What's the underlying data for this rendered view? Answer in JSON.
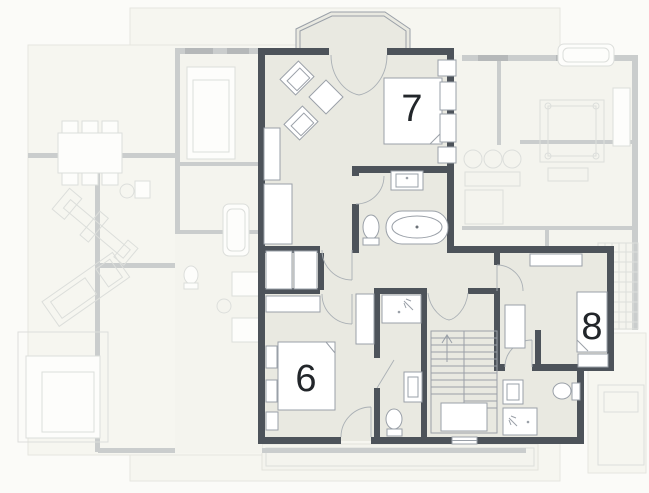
{
  "plan": {
    "kind": "floor-plan",
    "rooms": {
      "room6": {
        "label": "6"
      },
      "room7": {
        "label": "7"
      },
      "room8": {
        "label": "8"
      }
    },
    "fixtures": [
      "bathtub",
      "toilet",
      "washbasin",
      "shower",
      "staircase",
      "stair-up-arrow",
      "double-bed",
      "single-bed",
      "wardrobe",
      "armchair",
      "coffee-table",
      "dining-table",
      "bay-window",
      "french-doors",
      "door-swing",
      "entry-threshold"
    ]
  },
  "colors": {
    "bg": "#fbfbf8",
    "floor": "#e9e9e1",
    "wall": "#4d535a",
    "furniture_stroke": "#9aa0a8",
    "thin_line": "#aab0b5",
    "faded_floor": "#efefe7",
    "slab": "#f3f3eb",
    "faded_wall": "#a3a8ab",
    "faded_line": "#d6d6cc",
    "faded_line2": "#c4c8c4",
    "window_wall": "#7c8287",
    "label": "#22262a"
  }
}
